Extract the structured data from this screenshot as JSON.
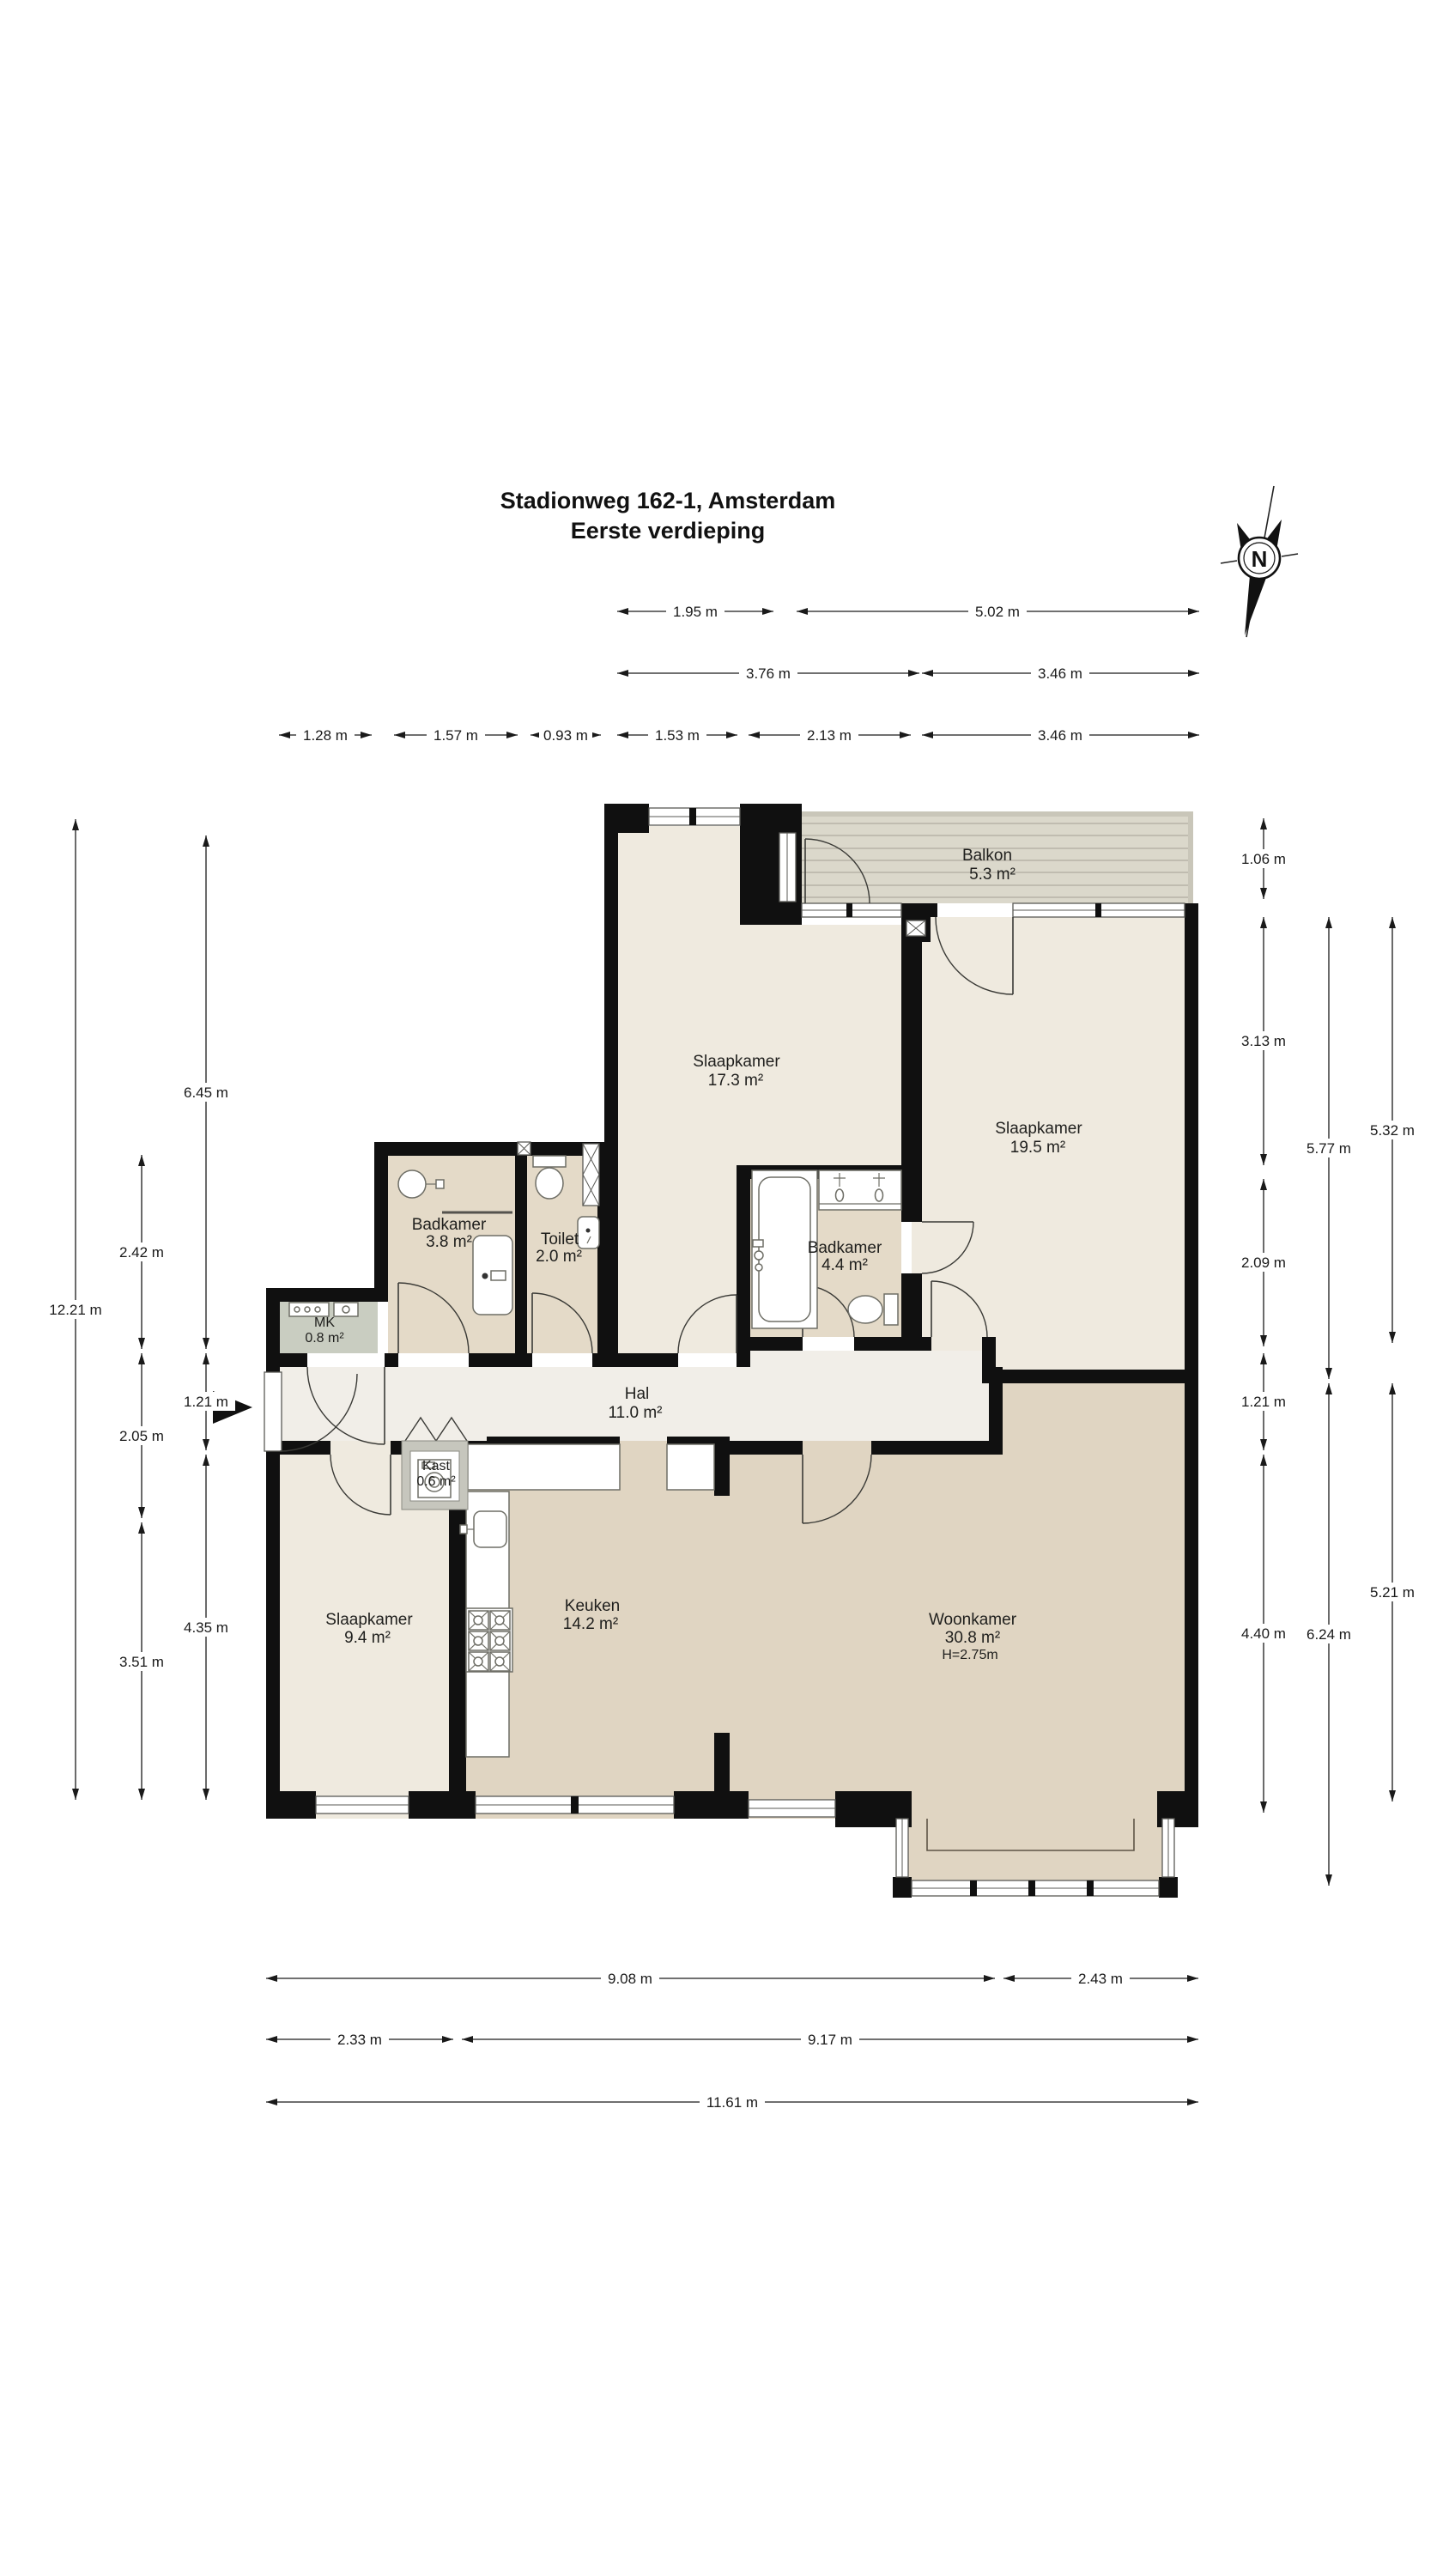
{
  "title": {
    "line1": "Stadionweg 162-1, Amsterdam",
    "line2": "Eerste verdieping"
  },
  "compass": {
    "north_label": "N"
  },
  "rooms": {
    "balkon": {
      "name": "Balkon",
      "area": "5.3 m²"
    },
    "slaapkamer1": {
      "name": "Slaapkamer",
      "area": "17.3 m²"
    },
    "slaapkamer2": {
      "name": "Slaapkamer",
      "area": "19.5 m²"
    },
    "badkamer1": {
      "name": "Badkamer",
      "area": "3.8 m²"
    },
    "toilet": {
      "name": "Toilet",
      "area": "2.0 m²"
    },
    "mk": {
      "name": "MK",
      "area": "0.8 m²"
    },
    "badkamer2": {
      "name": "Badkamer",
      "area": "4.4 m²"
    },
    "hal": {
      "name": "Hal",
      "area": "11.0 m²"
    },
    "kast": {
      "name": "Kast",
      "area": "0.6 m²"
    },
    "slaapkamer3": {
      "name": "Slaapkamer",
      "area": "9.4 m²"
    },
    "keuken": {
      "name": "Keuken",
      "area": "14.2 m²"
    },
    "woonkamer": {
      "name": "Woonkamer",
      "area": "30.8 m²",
      "ceiling": "H=2.75m"
    }
  },
  "dimensions": {
    "top_row1": [
      "1.95 m",
      "5.02 m"
    ],
    "top_row2": [
      "3.76 m",
      "3.46 m"
    ],
    "top_row3": [
      "1.28 m",
      "1.57 m",
      "0.93 m",
      "1.53 m",
      "2.13 m",
      "3.46 m"
    ],
    "bottom_row1": [
      "9.08 m",
      "2.43 m"
    ],
    "bottom_row2": [
      "2.33 m",
      "9.17 m"
    ],
    "bottom_row3": [
      "11.61 m"
    ],
    "left_outer": [
      "12.21 m"
    ],
    "left_mid": [
      "2.42 m",
      "2.05 m",
      "3.51 m"
    ],
    "left_inner": [
      "6.45 m",
      "1.21 m",
      "4.35 m"
    ],
    "right_inner": [
      "1.06 m",
      "3.13 m",
      "2.09 m",
      "1.21 m",
      "4.40 m"
    ],
    "right_mid": [
      "5.77 m",
      "6.24 m"
    ],
    "right_outer": [
      "5.32 m",
      "5.21 m"
    ]
  },
  "colors": {
    "wall": "#101010",
    "room_cream": "#EFEADF",
    "room_tan": "#E4DAC8",
    "room_dark_tan": "#E0D5C2",
    "hal": "#F1EEE8",
    "mk_gray": "#C9CDC1",
    "balkon_deck": "#DBD8CB",
    "background": "#FFFFFF"
  }
}
